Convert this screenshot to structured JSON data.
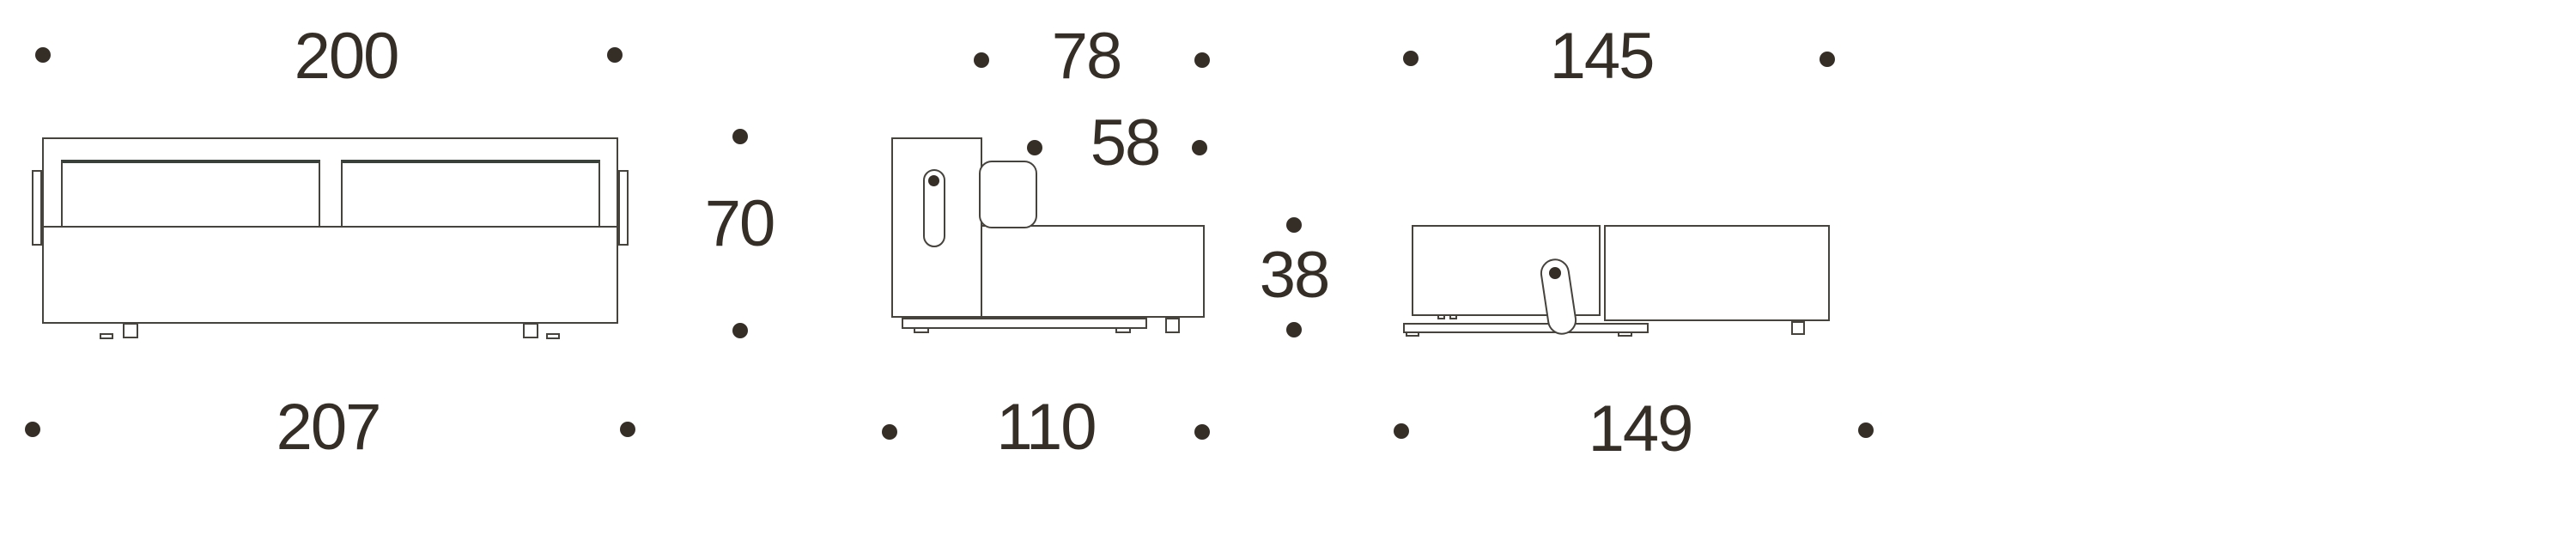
{
  "title": "sofa-bed-dimension-diagram",
  "colors": {
    "ink": "#352e27",
    "line": "#46433d",
    "cushion_edge": "#39403a",
    "background": "#ffffff"
  },
  "icons": {
    "dimension_marker": "small-filled-dot"
  },
  "views": {
    "front": {
      "name": "sofa-front-view",
      "dims": {
        "top_width": "200",
        "bottom_width": "207",
        "height": "70"
      }
    },
    "side": {
      "name": "sofa-side-view",
      "dims": {
        "upper_depth": "78",
        "seat_depth": "58",
        "seat_height": "38",
        "total_depth": "110"
      }
    },
    "bed": {
      "name": "sofa-folded-bed-view",
      "dims": {
        "top_length": "145",
        "bottom_length": "149"
      }
    }
  }
}
